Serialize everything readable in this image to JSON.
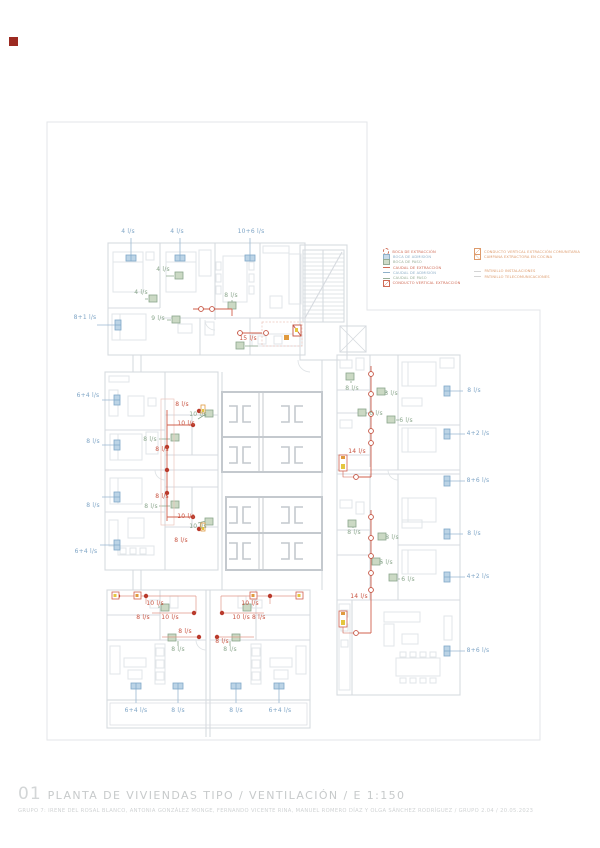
{
  "sheet": {
    "number": "01",
    "title": "PLANTA DE VIVIENDAS TIPO / VENTILACIÓN / E 1:150",
    "credits": "GRUPO 7: IRENE DEL ROSAL BLANCO, ANTONIA GONZÁLEZ MONGE, FERNANDO VICENTE RINA, MANUEL ROMERO DÍAZ Y OLGA SÁNCHEZ RODRÍGUEZ / GRUPO 2.04 / 20.05.2023",
    "scale": "E 1:150"
  },
  "colors": {
    "admission_blue": "#7fa8c9",
    "pass_green": "#8aa68c",
    "extraction_red": "#c4503e",
    "accent_orange": "#e09a3e",
    "logo_red": "#9c2a21",
    "wall_gray": "#d7dbe0"
  },
  "legend": {
    "left": [
      {
        "icon": "circle-red",
        "color": "lg-red",
        "label": "BOCA DE EXTRACCIÓN"
      },
      {
        "icon": "rect-blue",
        "color": "lg-blue",
        "label": "BOCA DE ADMISIÓN"
      },
      {
        "icon": "rect-green",
        "color": "lg-green",
        "label": "BOCA DE PASO"
      },
      {
        "icon": "line-red",
        "color": "lg-red",
        "label": "CAUDAL DE EXTRACCIÓN"
      },
      {
        "icon": "line-blue",
        "color": "lg-blue",
        "label": "CAUDAL DE ADMISIÓN"
      },
      {
        "icon": "line-green",
        "color": "lg-green",
        "label": "CAUDAL DE PASO"
      },
      {
        "icon": "slash-red",
        "color": "lg-red",
        "label": "CONDUCTO VERTICAL EXTRACCIÓN"
      }
    ],
    "right": [
      {
        "icon": "slash-orange",
        "color": "lg-orange",
        "label": "CONDUCTO VERTICAL EXTRACCIÓN COMUNITARIA",
        "spaced": false
      },
      {
        "icon": "diag-orange",
        "color": "lg-orange",
        "label": "CAMPANA EXTRACTORA EN COCINA",
        "spaced": false
      },
      {
        "icon": "dash-gray",
        "color": "lg-orange",
        "label": "PATINILLO INSTALACIONES",
        "spaced": true
      },
      {
        "icon": "dash-gray",
        "color": "lg-orange",
        "label": "PATINILLO TELECOMUNICACIONES",
        "spaced": false
      }
    ]
  },
  "flow_labels": [
    {
      "text": "4 l/s",
      "x": 128,
      "y": 232,
      "type": "blue"
    },
    {
      "text": "4 l/s",
      "x": 177,
      "y": 232,
      "type": "blue"
    },
    {
      "text": "10+6 l/s",
      "x": 251,
      "y": 232,
      "type": "blue"
    },
    {
      "text": "8+1 l/s",
      "x": 85,
      "y": 318,
      "type": "blue"
    },
    {
      "text": "6+4 l/s",
      "x": 88,
      "y": 396,
      "type": "blue"
    },
    {
      "text": "8 l/s",
      "x": 93,
      "y": 442,
      "type": "blue"
    },
    {
      "text": "8 l/s",
      "x": 93,
      "y": 506,
      "type": "blue"
    },
    {
      "text": "6+4 l/s",
      "x": 86,
      "y": 552,
      "type": "blue"
    },
    {
      "text": "6+4 l/s",
      "x": 136,
      "y": 711,
      "type": "blue"
    },
    {
      "text": "8 l/s",
      "x": 178,
      "y": 711,
      "type": "blue"
    },
    {
      "text": "8 l/s",
      "x": 236,
      "y": 711,
      "type": "blue"
    },
    {
      "text": "6+4 l/s",
      "x": 280,
      "y": 711,
      "type": "blue"
    },
    {
      "text": "8 l/s",
      "x": 474,
      "y": 391,
      "type": "blue"
    },
    {
      "text": "4+2 l/s",
      "x": 478,
      "y": 434,
      "type": "blue"
    },
    {
      "text": "8+6 l/s",
      "x": 478,
      "y": 481,
      "type": "blue"
    },
    {
      "text": "8 l/s",
      "x": 474,
      "y": 534,
      "type": "blue"
    },
    {
      "text": "4+2 l/s",
      "x": 478,
      "y": 577,
      "type": "blue"
    },
    {
      "text": "8+6 l/s",
      "x": 478,
      "y": 651,
      "type": "blue"
    },
    {
      "text": "4 l/s",
      "x": 163,
      "y": 270,
      "type": "green"
    },
    {
      "text": "4 l/s",
      "x": 141,
      "y": 293,
      "type": "green"
    },
    {
      "text": "9 l/s",
      "x": 158,
      "y": 319,
      "type": "green"
    },
    {
      "text": "8 l/s",
      "x": 231,
      "y": 296,
      "type": "green"
    },
    {
      "text": "8 l/s",
      "x": 150,
      "y": 440,
      "type": "green"
    },
    {
      "text": "10 l/s",
      "x": 198,
      "y": 415,
      "type": "green"
    },
    {
      "text": "8 l/s",
      "x": 151,
      "y": 507,
      "type": "green"
    },
    {
      "text": "10 l/s",
      "x": 198,
      "y": 527,
      "type": "green"
    },
    {
      "text": "8 l/s",
      "x": 352,
      "y": 389,
      "type": "green"
    },
    {
      "text": "8 l/s",
      "x": 391,
      "y": 394,
      "type": "green"
    },
    {
      "text": "6 l/s",
      "x": 376,
      "y": 414,
      "type": "green"
    },
    {
      "text": "6 l/s",
      "x": 406,
      "y": 421,
      "type": "green"
    },
    {
      "text": "8 l/s",
      "x": 354,
      "y": 533,
      "type": "green"
    },
    {
      "text": "8 l/s",
      "x": 392,
      "y": 538,
      "type": "green"
    },
    {
      "text": "6 l/s",
      "x": 386,
      "y": 563,
      "type": "green"
    },
    {
      "text": "6 l/s",
      "x": 408,
      "y": 580,
      "type": "green"
    },
    {
      "text": "8 l/s",
      "x": 178,
      "y": 650,
      "type": "green"
    },
    {
      "text": "8 l/s",
      "x": 230,
      "y": 650,
      "type": "green"
    },
    {
      "text": "15 l/s",
      "x": 248,
      "y": 339,
      "type": "red"
    },
    {
      "text": "8 l/s",
      "x": 182,
      "y": 405,
      "type": "red"
    },
    {
      "text": "10 l/s",
      "x": 186,
      "y": 424,
      "type": "red"
    },
    {
      "text": "8 l/s",
      "x": 162,
      "y": 450,
      "type": "red"
    },
    {
      "text": "8 l/s",
      "x": 162,
      "y": 497,
      "type": "red"
    },
    {
      "text": "10 l/s",
      "x": 186,
      "y": 517,
      "type": "red"
    },
    {
      "text": "8 l/s",
      "x": 181,
      "y": 541,
      "type": "red"
    },
    {
      "text": "14 l/s",
      "x": 357,
      "y": 452,
      "type": "red"
    },
    {
      "text": "14 l/s",
      "x": 359,
      "y": 597,
      "type": "red"
    },
    {
      "text": "10 l/s",
      "x": 155,
      "y": 604,
      "type": "red"
    },
    {
      "text": "8 l/s",
      "x": 143,
      "y": 618,
      "type": "red"
    },
    {
      "text": "10 l/s",
      "x": 170,
      "y": 618,
      "type": "red"
    },
    {
      "text": "8 l/s",
      "x": 185,
      "y": 632,
      "type": "red"
    },
    {
      "text": "10 l/s",
      "x": 250,
      "y": 604,
      "type": "red"
    },
    {
      "text": "10 l/s 8 l/s",
      "x": 249,
      "y": 618,
      "type": "red"
    },
    {
      "text": "8 l/s",
      "x": 222,
      "y": 642,
      "type": "red"
    }
  ]
}
